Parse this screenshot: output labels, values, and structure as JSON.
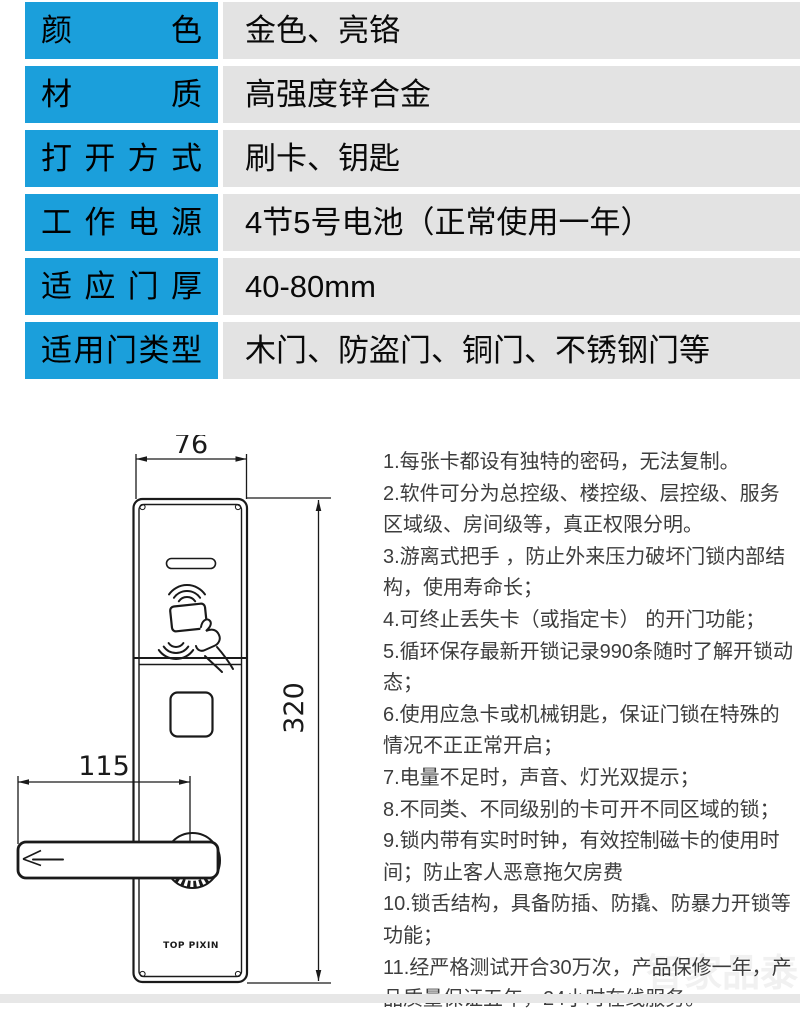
{
  "table": {
    "rows": [
      {
        "label": "颜色",
        "value": "金色、亮铬"
      },
      {
        "label": "材质",
        "value": "高强度锌合金"
      },
      {
        "label": "打开方式",
        "value": "刷卡、钥匙"
      },
      {
        "label": "工作电源",
        "value": "4节5号电池（正常使用一年）"
      },
      {
        "label": "适应门厚",
        "value": "40-80mm"
      },
      {
        "label": "适用门类型",
        "value": "木门、防盗门、铜门、不锈钢门等"
      }
    ]
  },
  "diagram": {
    "width_dim": "76",
    "height_dim": "320",
    "handle_dim": "115",
    "brand": "TOP PIXIN"
  },
  "features": {
    "items": [
      "1.每张卡都设有独特的密码，无法复制。",
      "2.软件可分为总控级、楼控级、层控级、服务区域级、房间级等，真正权限分明。",
      "3.游离式把手  ，防止外来压力破坏门锁内部结构，使用寿命长；",
      "4.可终止丢失卡（或指定卡） 的开门功能；",
      "5.循环保存最新开锁记录990条随时了解开锁动态；",
      "6.使用应急卡或机械钥匙，保证门锁在特殊的情况不正正常开启；",
      "7.电量不足时，声音、灯光双提示；",
      "8.不同类、不同级别的卡可开不同区域的锁；",
      "9.锁内带有实时时钟，有效控制磁卡的使用时间；防止客人恶意拖欠房费",
      "10.锁舌结构，具备防插、防撬、防暴力开锁等功能；",
      "11.经严格测试开合30万次，产品保修一年，产品质量保证五年，24小时在线服务。"
    ]
  },
  "watermark": "智家品泰",
  "colors": {
    "label_bg": "#1b9fdb",
    "value_bg": "#e3e3e3",
    "line": "#1a1a1a"
  }
}
